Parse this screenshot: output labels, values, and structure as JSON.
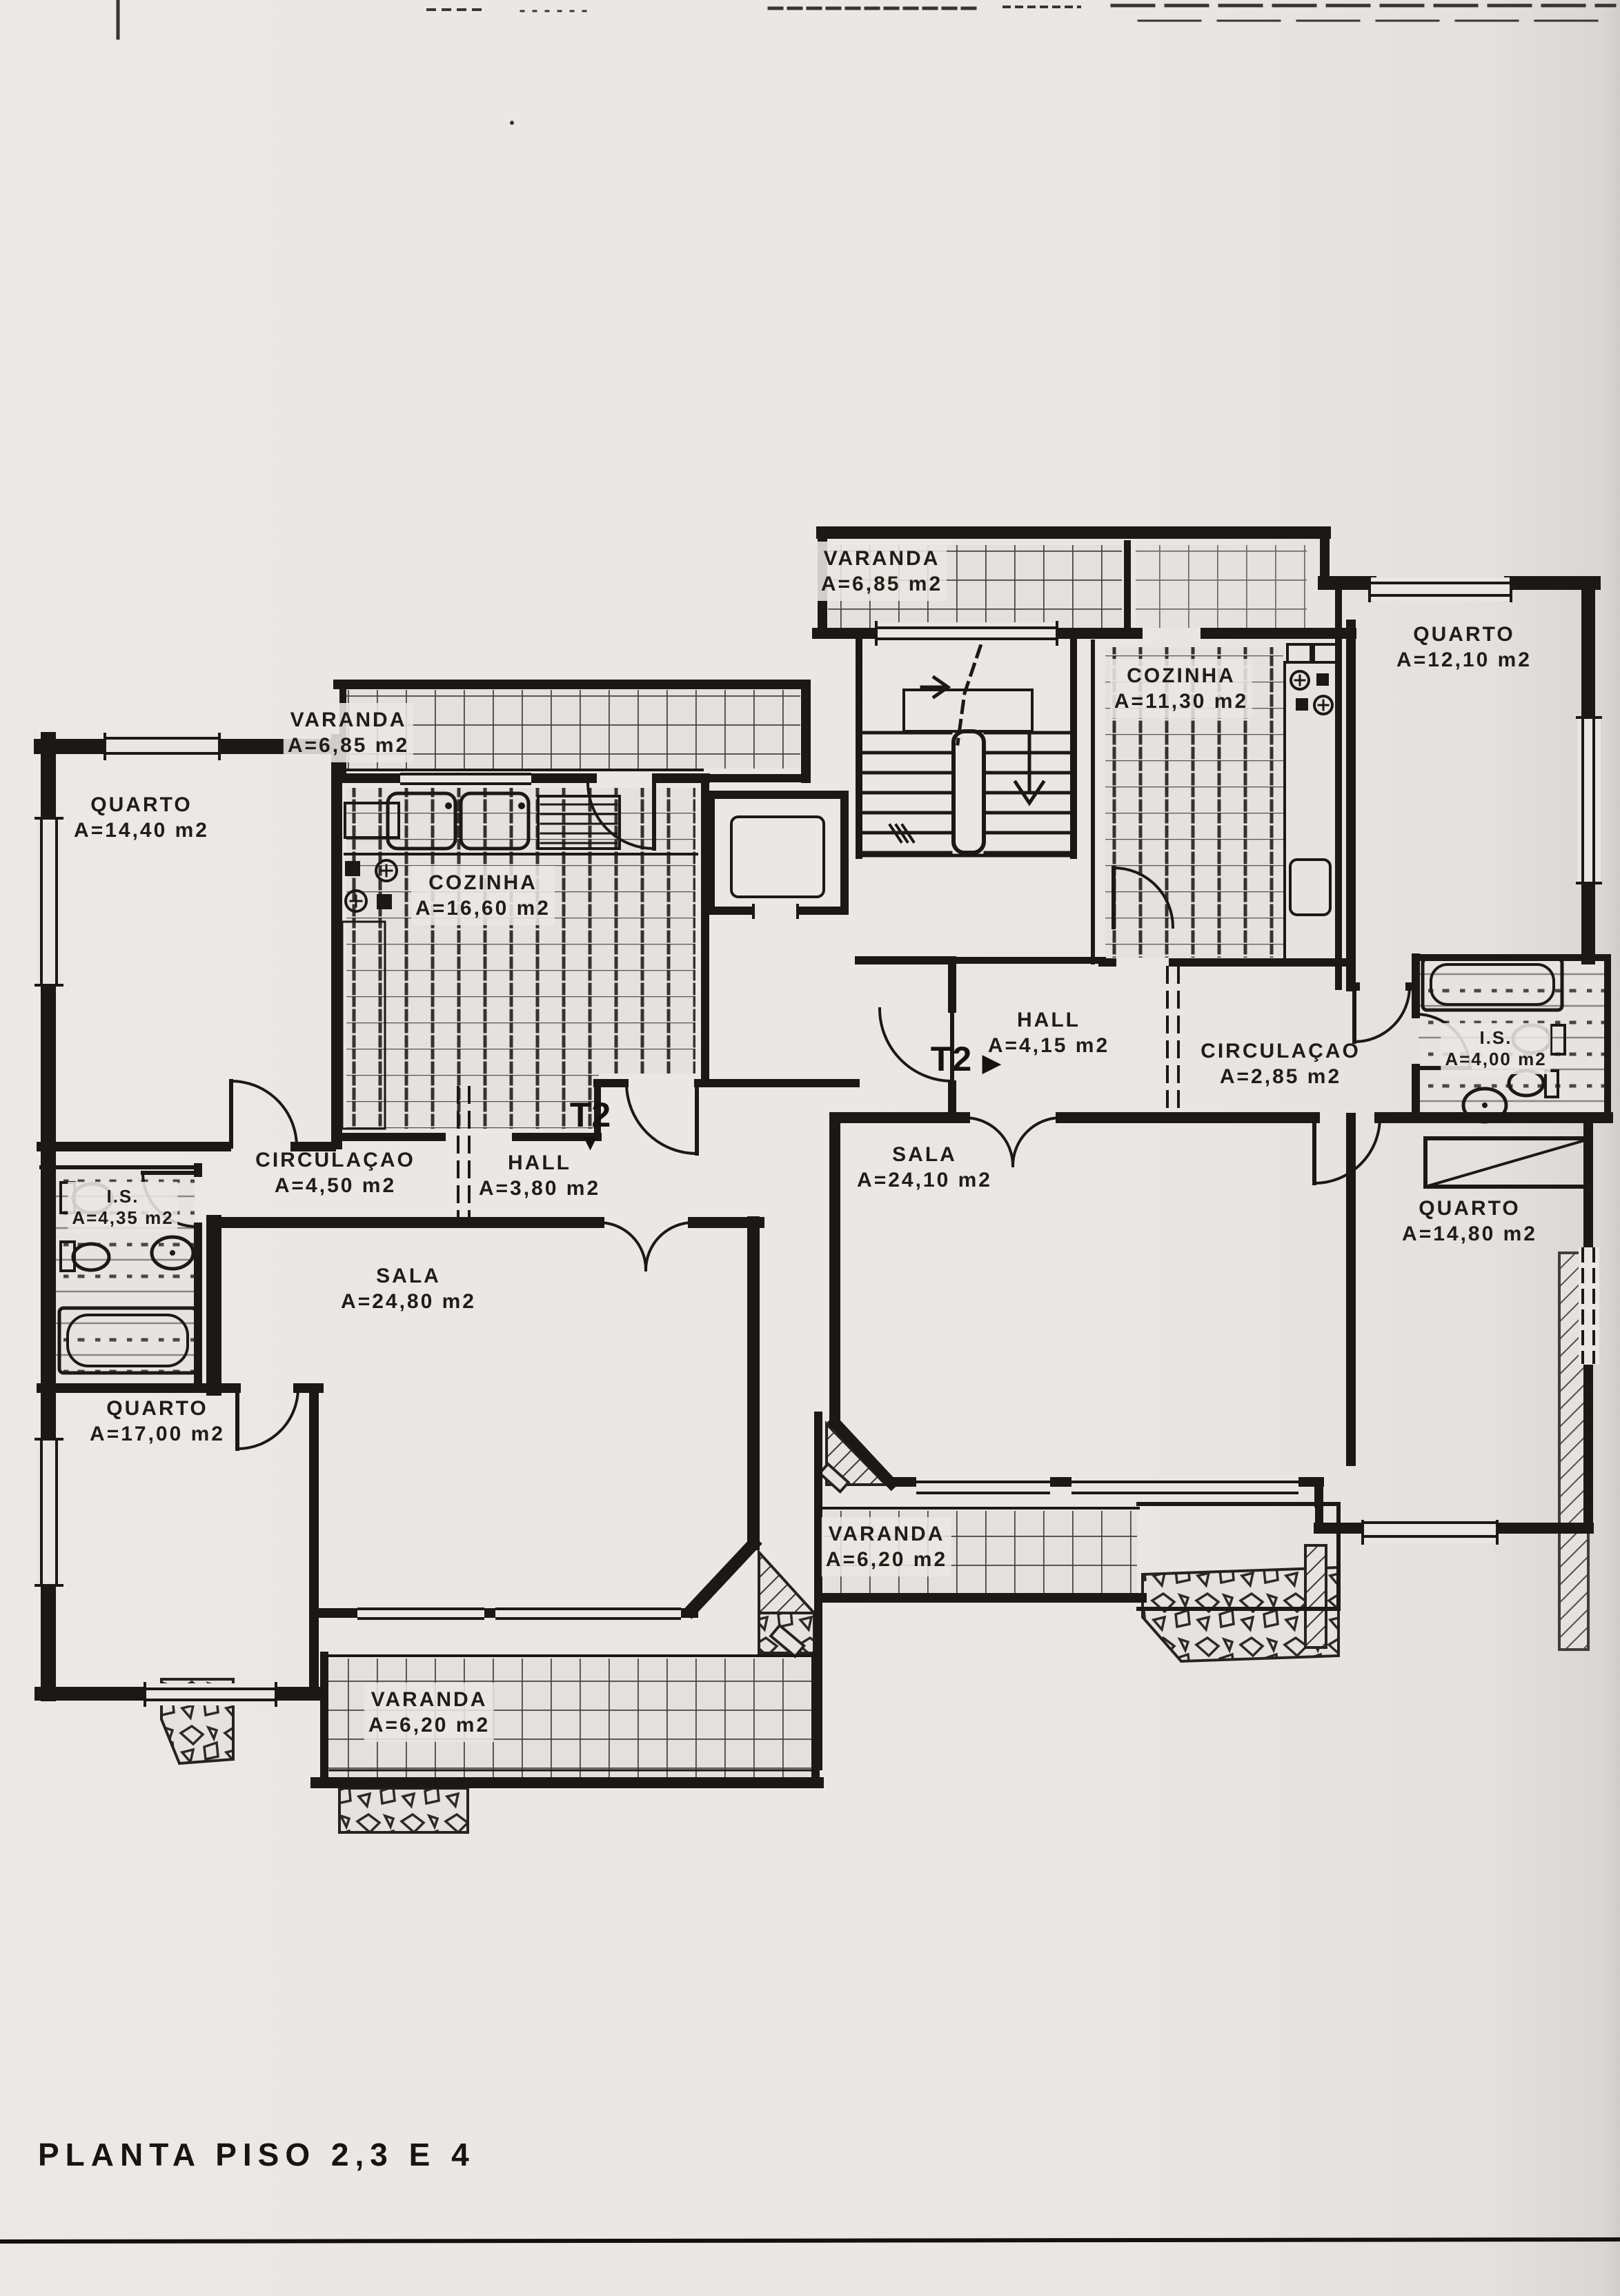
{
  "title": "PLANTA PISO 2,3 E 4",
  "unit_markers": {
    "left": {
      "label": "T2",
      "arrow": "▼"
    },
    "right": {
      "label": "T2",
      "arrow": "▶"
    }
  },
  "rooms": {
    "varanda_top": {
      "name": "VARANDA",
      "area": "A=6,85 m2"
    },
    "cozinha_right": {
      "name": "COZINHA",
      "area": "A=11,30 m2"
    },
    "quarto_top_right": {
      "name": "QUARTO",
      "area": "A=12,10 m2"
    },
    "quarto_top_left": {
      "name": "QUARTO",
      "area": "A=14,40 m2"
    },
    "varanda_left": {
      "name": "VARANDA",
      "area": "A=6,85 m2"
    },
    "cozinha_left": {
      "name": "COZINHA",
      "area": "A=16,60 m2"
    },
    "hall_right": {
      "name": "HALL",
      "area": "A=4,15 m2"
    },
    "circulacao_right": {
      "name": "CIRCULAÇAO",
      "area": "A=2,85 m2"
    },
    "is_right": {
      "name": "I.S.",
      "area": "A=4,00 m2"
    },
    "circulacao_left": {
      "name": "CIRCULAÇAO",
      "area": "A=4,50 m2"
    },
    "hall_left": {
      "name": "HALL",
      "area": "A=3,80 m2"
    },
    "sala_right": {
      "name": "SALA",
      "area": "A=24,10 m2"
    },
    "is_left": {
      "name": "I.S.",
      "area": "A=4,35 m2"
    },
    "sala_left": {
      "name": "SALA",
      "area": "A=24,80 m2"
    },
    "quarto_right": {
      "name": "QUARTO",
      "area": "A=14,80 m2"
    },
    "quarto_bottom_left": {
      "name": "QUARTO",
      "area": "A=17,00 m2"
    },
    "varanda_bottom_right": {
      "name": "VARANDA",
      "area": "A=6,20 m2"
    },
    "varanda_bottom_left": {
      "name": "VARANDA",
      "area": "A=6,20 m2"
    }
  }
}
